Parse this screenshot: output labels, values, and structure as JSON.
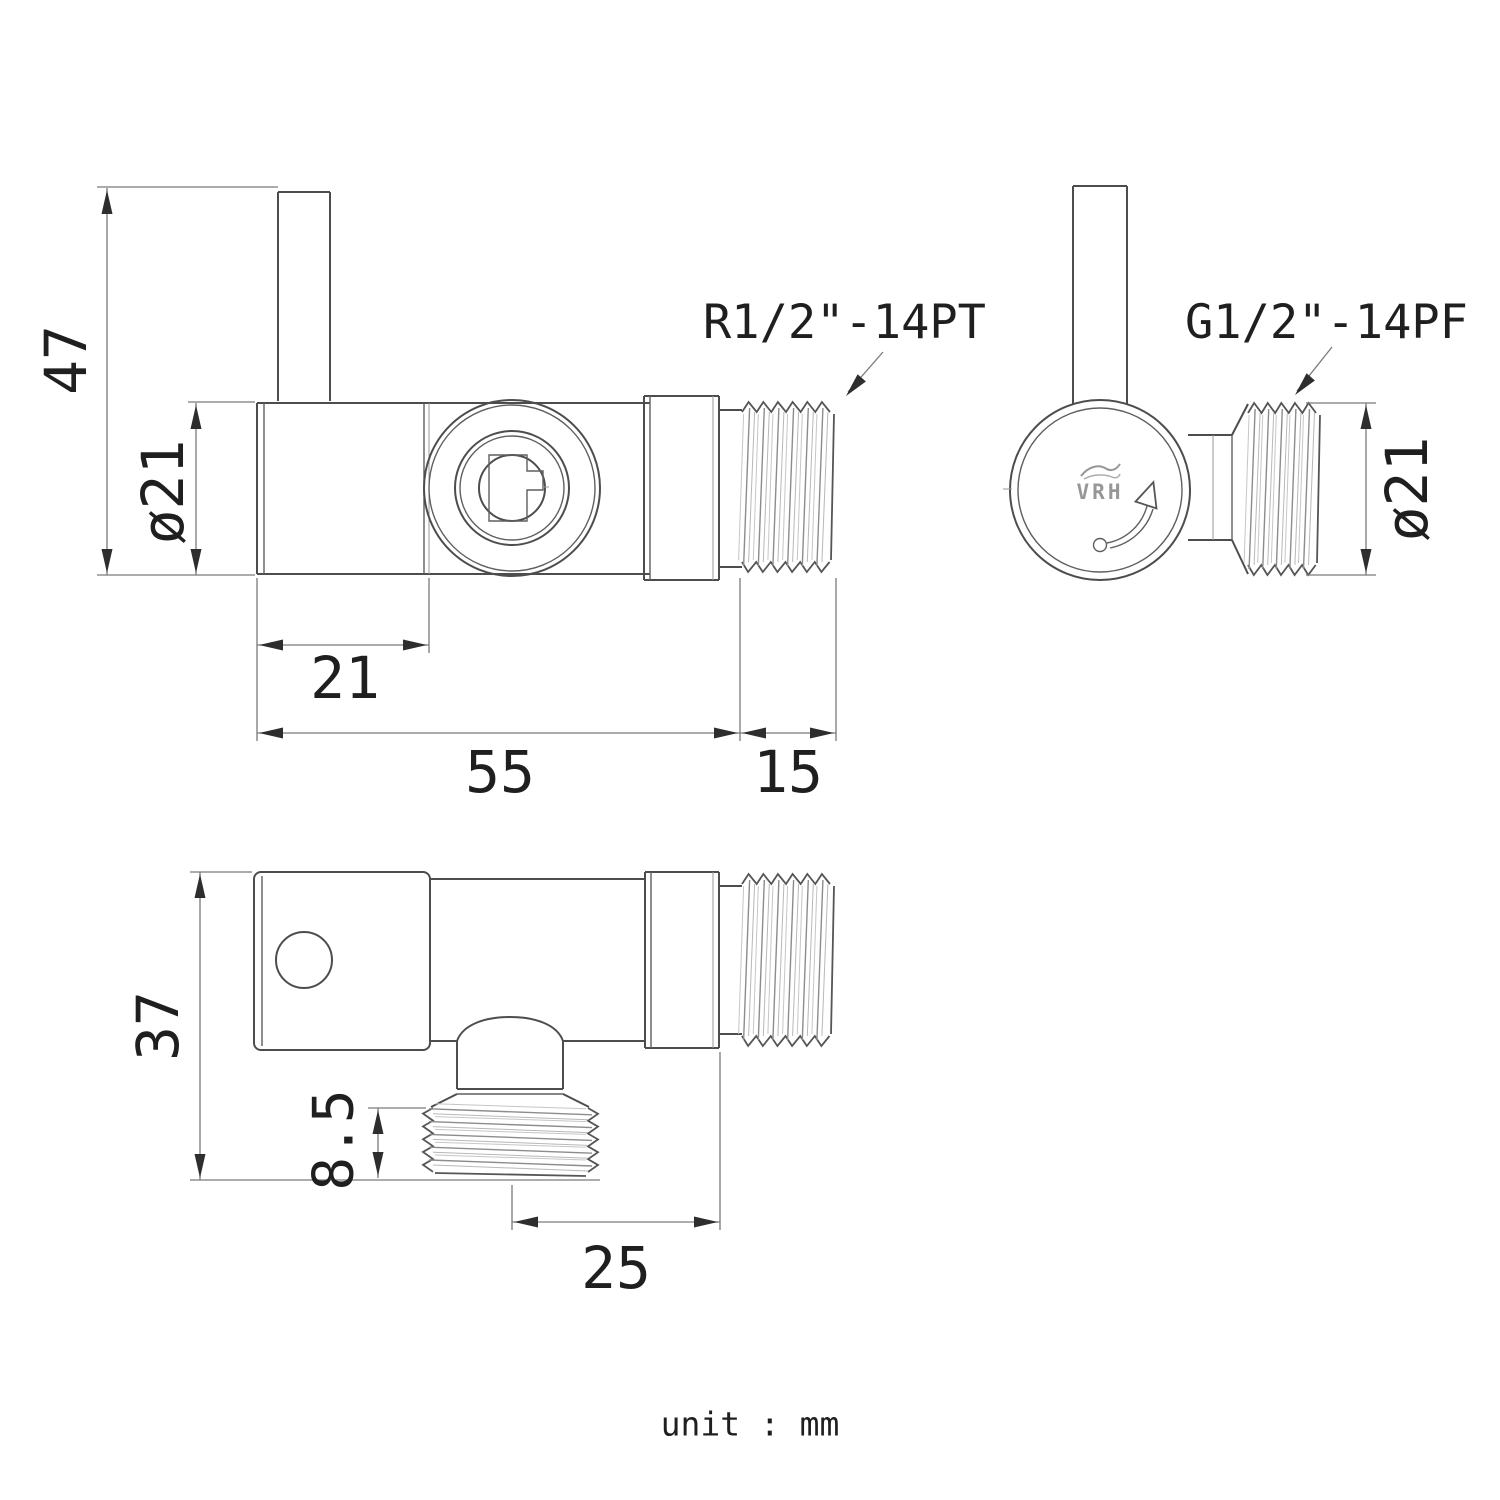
{
  "views": {
    "side": {
      "dim_height": "47",
      "dim_diameter": "ø21",
      "dim_offset": "21",
      "dim_length": "55",
      "dim_thread_length": "15",
      "thread_spec": "R1/2\"-14PT"
    },
    "end": {
      "thread_spec": "G1/2\"-14PF",
      "dim_diameter": "ø21"
    },
    "top": {
      "dim_depth": "37",
      "dim_thread_height": "8.5",
      "dim_offset": "25"
    }
  },
  "brand": {
    "logo": "VRH"
  },
  "footer": {
    "unit_label": "unit : mm"
  },
  "colors": {
    "background": "#ffffff",
    "outline": "#4d4d4d",
    "dimension_line": "#7a7a7a",
    "text": "#1f1f1f",
    "logo_gray": "#979797"
  }
}
